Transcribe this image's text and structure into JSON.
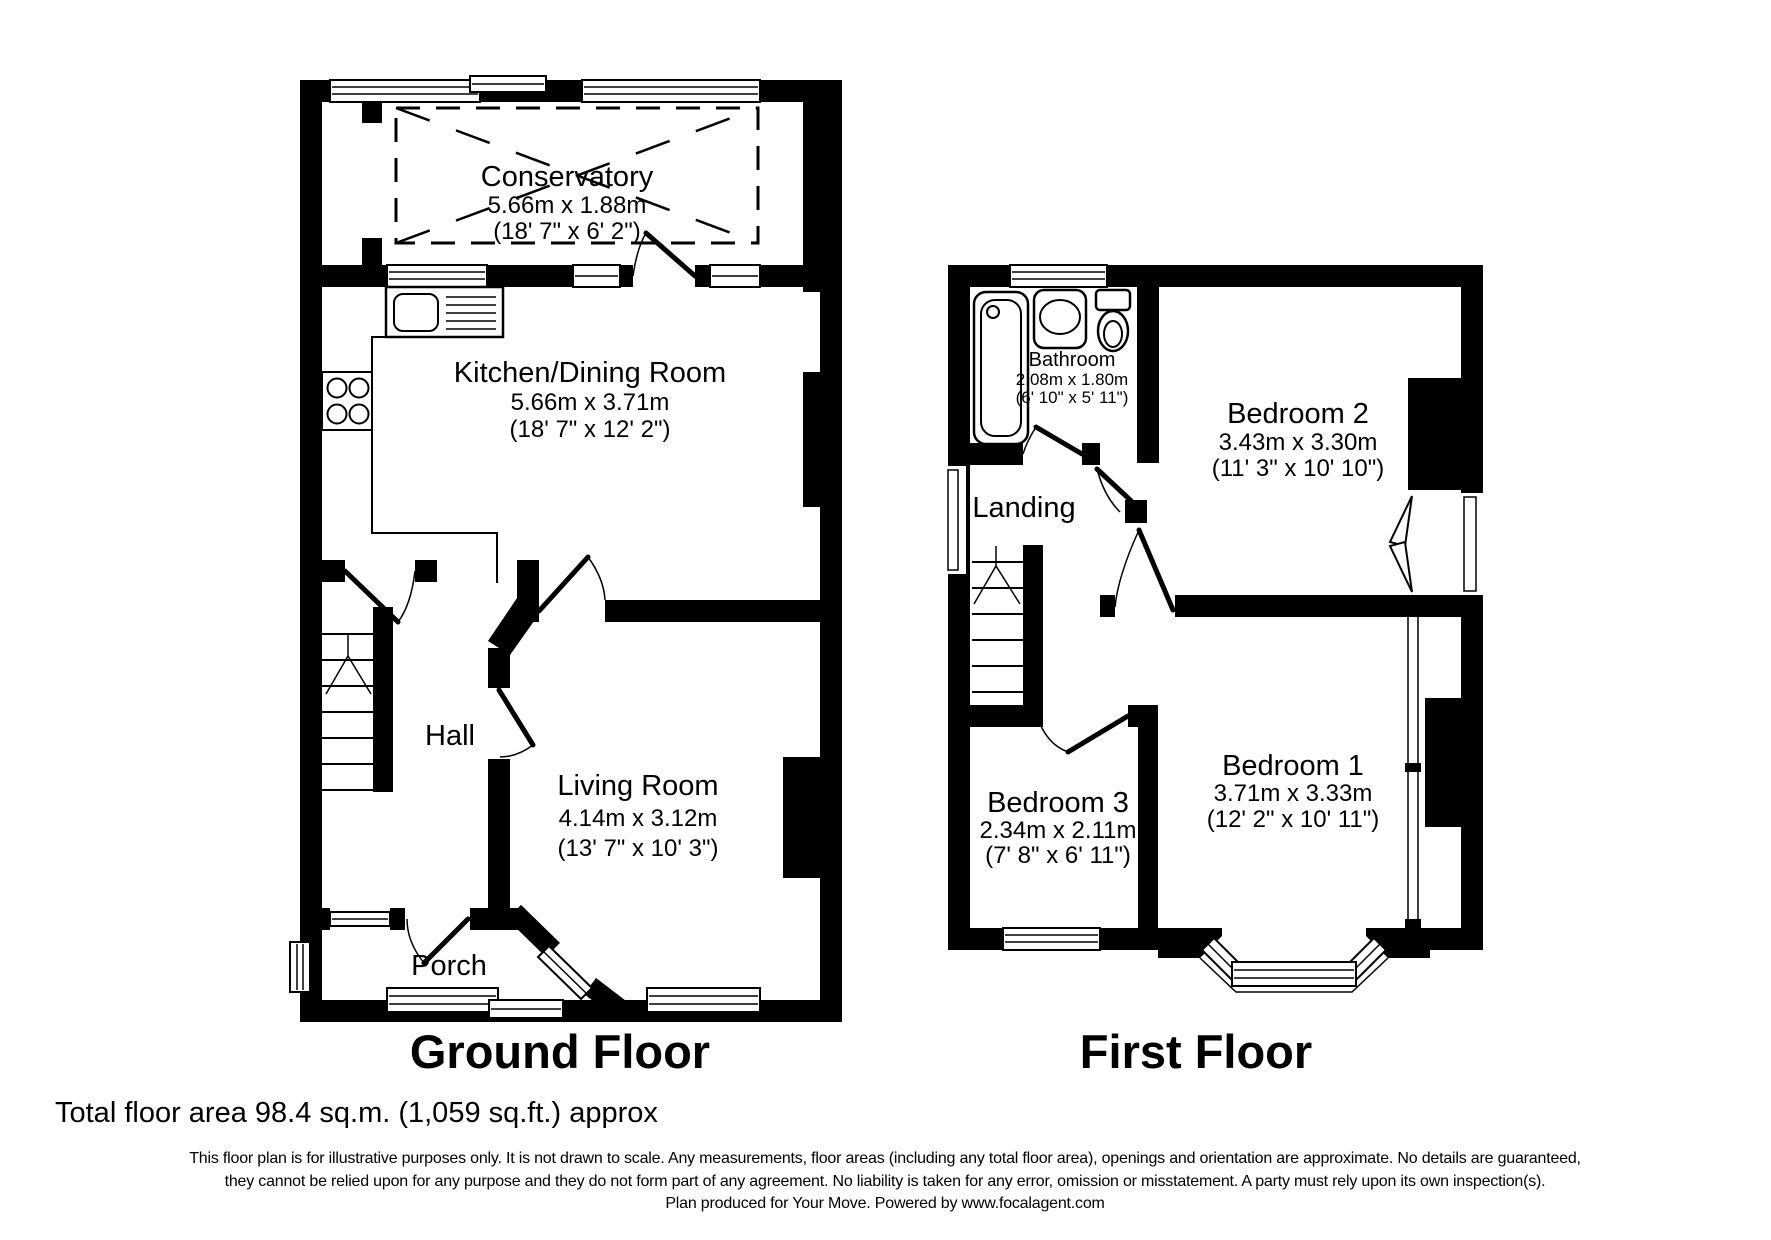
{
  "page": {
    "background": "#ffffff"
  },
  "colors": {
    "wall": "#000000",
    "text": "#000000",
    "line": "#000000"
  },
  "ground_floor": {
    "title": "Ground Floor",
    "rooms": {
      "conservatory": {
        "name": "Conservatory",
        "metric": "5.66m x 1.88m",
        "imperial": "(18' 7\" x 6' 2\")"
      },
      "kitchen_dining": {
        "name": "Kitchen/Dining Room",
        "metric": "5.66m x 3.71m",
        "imperial": "(18' 7\" x 12' 2\")"
      },
      "hall": {
        "name": "Hall"
      },
      "living_room": {
        "name": "Living Room",
        "metric": "4.14m x 3.12m",
        "imperial": "(13' 7\" x 10' 3\")"
      },
      "porch": {
        "name": "Porch"
      }
    }
  },
  "first_floor": {
    "title": "First Floor",
    "rooms": {
      "bathroom": {
        "name": "Bathroom",
        "metric": "2.08m x 1.80m",
        "imperial": "(6' 10\" x 5' 11\")"
      },
      "bedroom_2": {
        "name": "Bedroom 2",
        "metric": "3.43m x 3.30m",
        "imperial": "(11' 3\" x 10' 10\")"
      },
      "landing": {
        "name": "Landing"
      },
      "bedroom_3": {
        "name": "Bedroom 3",
        "metric": "2.34m x 2.11m",
        "imperial": "(7' 8\" x 6' 11\")"
      },
      "bedroom_1": {
        "name": "Bedroom 1",
        "metric": "3.71m x 3.33m",
        "imperial": "(12' 2\" x 10' 11\")"
      }
    }
  },
  "footer": {
    "total_area": "Total floor area 98.4 sq.m. (1,059 sq.ft.) approx",
    "disclaimer": [
      "This floor plan is for illustrative purposes only. It is not drawn to scale. Any measurements, floor areas (including any total floor area), openings and orientation are approximate. No details are guaranteed,",
      "they cannot be relied upon for any purpose and they do not form part of any agreement. No liability is taken for any error, omission or misstatement. A party must rely upon its own inspection(s).",
      "Plan produced for Your Move. Powered by www.focalagent.com"
    ]
  },
  "icons": {
    "bathtub-icon": "rounded rectangle tub outline",
    "washbasin-icon": "oval basin in rounded square",
    "toilet-icon": "cistern with oval bowl",
    "hob-icon": "four burner circles",
    "kitchen-sink-icon": "sink bowl with drainer lines",
    "stairs-icon": "treads with up arrow",
    "window-icon": "double parallel lines",
    "door-icon": "leaf with quarter-circle swing"
  }
}
